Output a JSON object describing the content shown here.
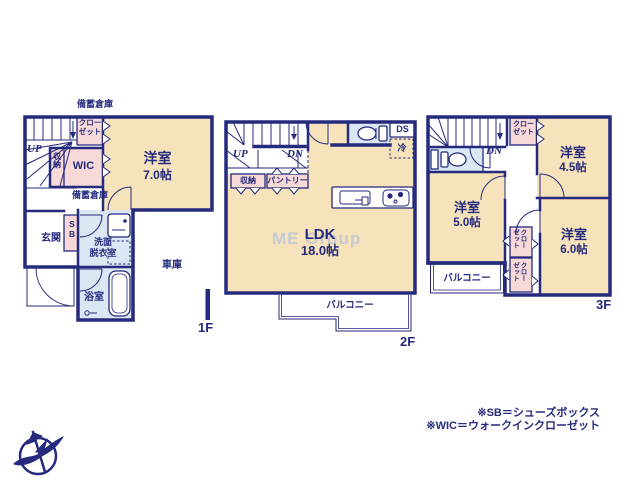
{
  "colors": {
    "wall": "#252a7d",
    "room": "#f6e3bb",
    "closet": "#f7d9d8",
    "wet": "#dbe8f4",
    "text": "#252a7d"
  },
  "watermark": "ME Group",
  "legend": {
    "sb": "※SB＝シューズボックス",
    "wic": "※WIC＝ウォークインクローゼット"
  },
  "floor1": {
    "label": "1F",
    "storage_top": "備蓄倉庫",
    "storage_mid": "備蓄倉庫",
    "stairs_up": "UP",
    "closet_l1": "クロー",
    "closet_l2": "ゼット",
    "storage_small": "収納",
    "wic": "WIC",
    "room": {
      "name": "洋室",
      "size": "7.0帖"
    },
    "entrance": "玄関",
    "shoe_box": "SB",
    "washroom_l1": "洗面",
    "washroom_l2": "脱衣室",
    "bathroom": "浴室",
    "garage": "車庫"
  },
  "floor2": {
    "label": "2F",
    "stairs_up": "UP",
    "stairs_down": "DN",
    "storage": "収納",
    "pantry": "パントリー",
    "duct": "DS",
    "fridge": "冷",
    "ldk": {
      "name": "LDK",
      "size": "18.0帖"
    },
    "balcony": "バルコニー"
  },
  "floor3": {
    "label": "3F",
    "stairs_down": "DN",
    "closet_top_l1": "クロー",
    "closet_top_l2": "ゼット",
    "room_a": {
      "name": "洋室",
      "size": "4.5帖"
    },
    "room_b": {
      "name": "洋室",
      "size": "5.0帖"
    },
    "room_c": {
      "name": "洋室",
      "size": "6.0帖"
    },
    "closet_a_l1": "クロー",
    "closet_a_l2": "ゼット",
    "closet_b_l1": "クロー",
    "closet_b_l2": "ゼット",
    "balcony": "バルコニー"
  }
}
